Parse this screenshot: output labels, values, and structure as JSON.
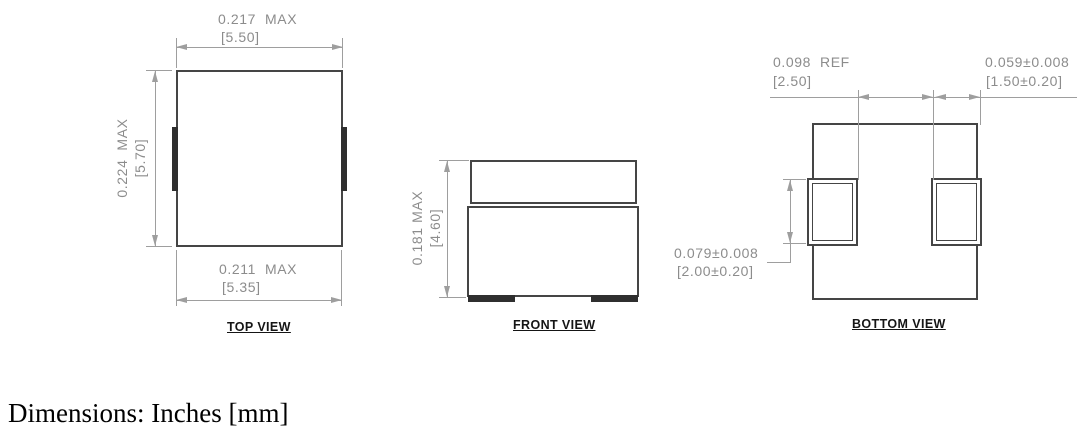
{
  "footer": {
    "text": "Dimensions: Inches [mm]"
  },
  "colors": {
    "outline": "#454545",
    "dimension_lines": "#9e9e9e",
    "dimension_text": "#8c8c8c",
    "labels": "#151515"
  },
  "views": {
    "top": {
      "label": "TOP VIEW",
      "dim_width_top_inch": "0.217  MAX",
      "dim_width_top_mm": "[5.50]",
      "dim_height_inch": "0.224  MAX",
      "dim_height_mm": "[5.70]",
      "dim_width_bottom_inch": "0.211  MAX",
      "dim_width_bottom_mm": "[5.35]"
    },
    "front": {
      "label": "FRONT VIEW",
      "dim_height_inch": "0.181 MAX",
      "dim_height_mm": "[4.60]"
    },
    "bottom": {
      "label": "BOTTOM VIEW",
      "dim_pad_gap_inch": "0.098  REF",
      "dim_pad_gap_mm": "[2.50]",
      "dim_pad_width_inch": "0.059±0.008",
      "dim_pad_width_mm": "[1.50±0.20]",
      "dim_pad_height_inch": "0.079±0.008",
      "dim_pad_height_mm": "[2.00±0.20]"
    }
  }
}
